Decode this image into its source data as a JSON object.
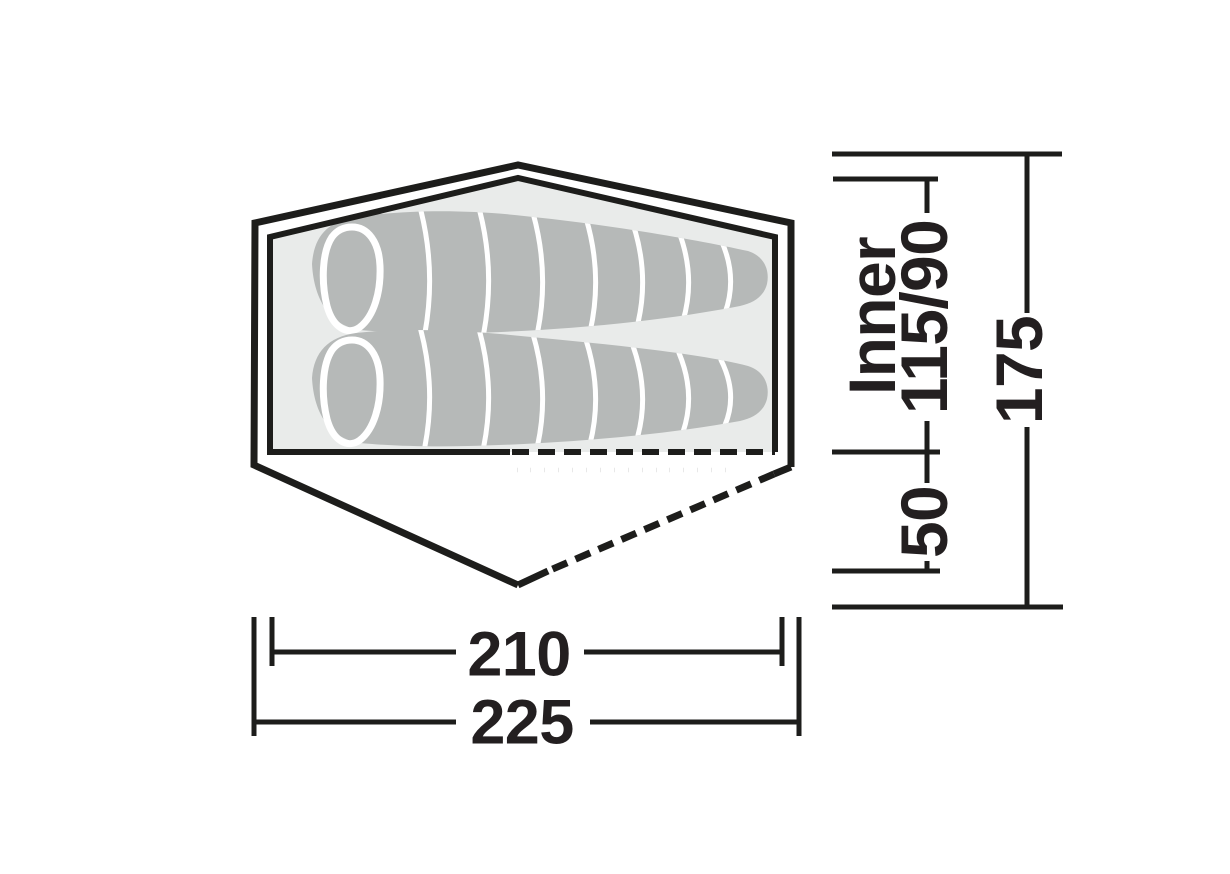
{
  "diagram": {
    "name": "tent-top-view-dimension-diagram",
    "description": "Top view floor plan of a two-person tent with two sleeping bags, flysheet outline, inner tent, dashed door edge and dimension lines (cm)"
  },
  "colors": {
    "background": "#ffffff",
    "line": "#1d1d1b",
    "inner_fill": "#e9ebea",
    "bag_fill": "#b6b9b8",
    "text": "#231f20"
  },
  "dims": {
    "inner": {
      "label": "Inner",
      "value": "115/90"
    },
    "porch_depth": {
      "value": "50"
    },
    "total_depth": {
      "value": "175"
    },
    "inner_length": {
      "value": "210"
    },
    "total_length": {
      "value": "225"
    }
  }
}
